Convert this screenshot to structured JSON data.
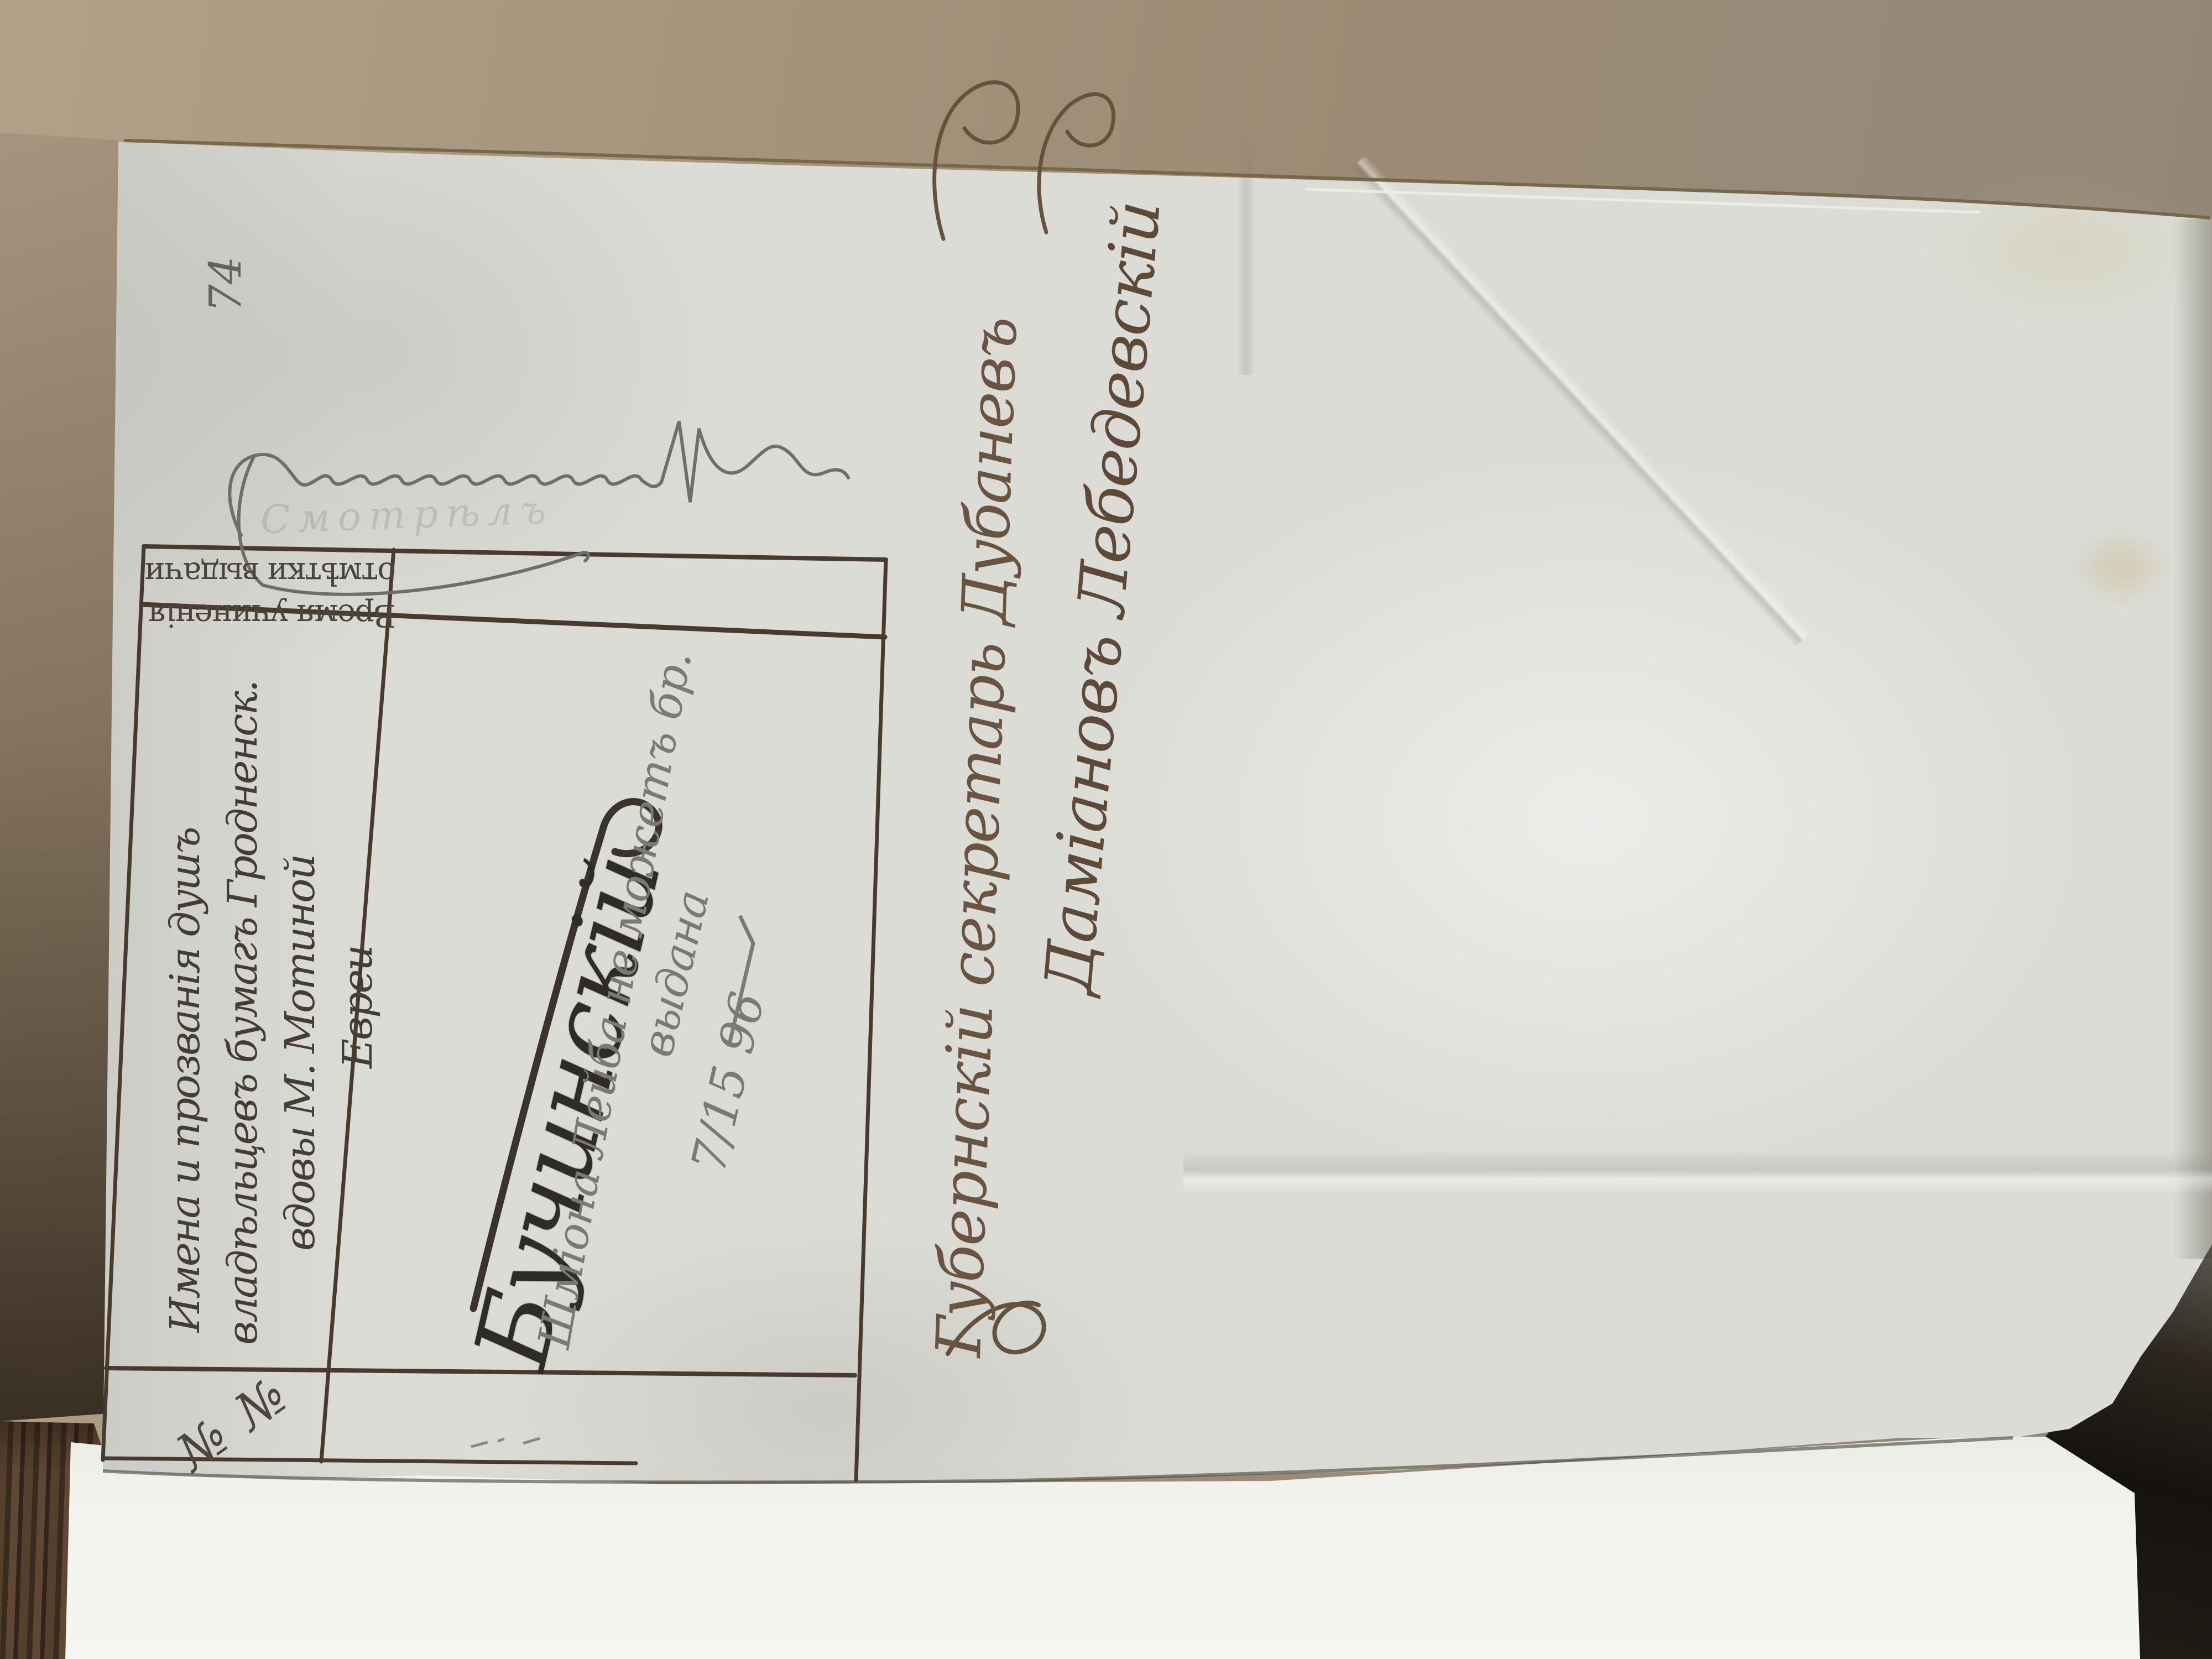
{
  "page": {
    "page_number": "74",
    "inspector_scrawl": "Смотрѣлъ"
  },
  "table": {
    "no_column_header": "№ №",
    "main_column_header_lines": [
      "Имена и прозванія душъ",
      "владѣльцевъ бумагъ Гродненск.",
      "вдовы М. Мотиной",
      "Евреи"
    ],
    "side_column_header_lines": [
      "Время учиненія",
      "отмѣтки выдачи"
    ],
    "entry": {
      "name_ink": "Бучинскій",
      "pencil_note": "Шмiона Лейба не можетъ бр.",
      "pencil_note2": "выдана",
      "pencil_date": "7/15 96"
    }
  },
  "signatures": {
    "line1": "Губернскій секретарь Дубаневъ",
    "line2": "Дамiановъ Лебедевскій"
  },
  "colors": {
    "cardboard": "#a5947c",
    "wood": "#3b2b1f",
    "paper": "#dadcd5",
    "under_paper": "#f1f2ed",
    "ink_lines": "#493a2e",
    "ink_script": "#6a5440",
    "pencil": "#7b7a72"
  }
}
